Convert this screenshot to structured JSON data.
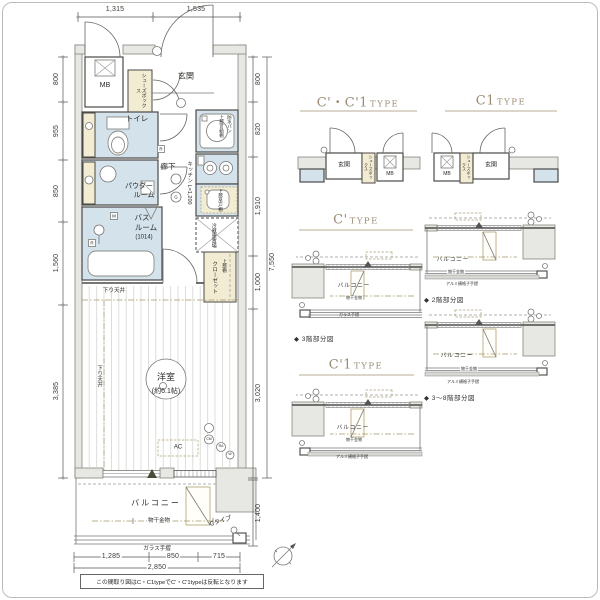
{
  "frame": {
    "note": "この間取り図はC・C1typeでC'・C'1typeは反転となります"
  },
  "colors": {
    "wet_blue": "#d3e2eb",
    "beige": "#f2ecd2",
    "wall_gray": "#e7e7e3",
    "heading_brown": "#9b8b73"
  },
  "dims": {
    "top": {
      "d1": "1,315",
      "d2": "1,535"
    },
    "left": {
      "d1": "800",
      "d2": "955",
      "d3": "850",
      "d4": "1,560",
      "d5": "3,385"
    },
    "right": {
      "d1": "800",
      "d2": "820",
      "d3": "1,910",
      "d4": "1,000",
      "d5": "3,020",
      "total": "7,550",
      "balcony": "1,400"
    },
    "bottom": {
      "d1": "1,285",
      "d2": "850",
      "d3": "715",
      "total": "2,850"
    }
  },
  "rooms": {
    "mb": "MB",
    "shoes": "シューズボックス",
    "entrance": "玄関",
    "toilet": "トイレ",
    "powder_l1": "パウダー",
    "powder_l2": "ルーム",
    "bath_l1": "バス",
    "bath_l2": "ルーム",
    "bath_size": "(1014)",
    "hall": "廊下",
    "kitchen": "キッチン L=1,200",
    "pan_shelf": "上部可動棚",
    "pan": "防水パン",
    "cupboard": "上部吊戸棚",
    "fridge": "冷蔵庫置場",
    "closet_shelf": "上部棚",
    "closet": "クローゼット",
    "room": "洋室",
    "room_size": "(約6.1帖)",
    "down_ceiling": "下り天井",
    "ac": "AC",
    "balcony": "バルコニー",
    "laundry": "物干金物",
    "glass_rail": "ガラス手摺",
    "c_type": "Cタイプ"
  },
  "symbols": {
    "g": "G",
    "m": "M",
    "r": "R",
    "cm": "CM",
    "ra": "RA",
    "w": "W"
  },
  "panels": {
    "type_word": "TYPE",
    "p1_code": "C'・C'1",
    "p2_code": "C1",
    "p3_code": "C'",
    "p4_code": "C'1",
    "cap_3f": "◆ 3階部分図",
    "cap_2f": "◆ 2階部分図",
    "cap_38f": "◆ 3〜8階部分図",
    "mini_entrance": "玄関",
    "mini_mb": "MB",
    "mini_shoes": "シューズボックス",
    "mini_balcony": "バルコニー",
    "mini_laundry": "物干金物",
    "mini_alumi_rail": "アルミ横格子手摺",
    "mini_glass_rail": "ガラス手摺"
  }
}
